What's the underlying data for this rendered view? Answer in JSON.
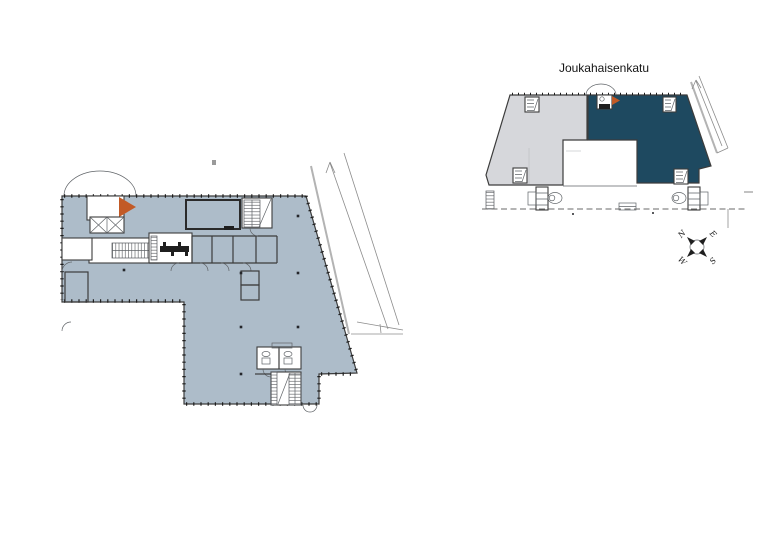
{
  "overview": {
    "street_label": "Joukahaisenkatu"
  },
  "compass": {
    "north": "N",
    "east": "E",
    "south": "S",
    "west": "W"
  },
  "colors": {
    "floor_plan_fill": "#adbcc9",
    "overview_building_fill": "#d6d7db",
    "overview_highlight_fill": "#1e4960",
    "entrance_marker_orange": "#c25a26"
  },
  "icons": {
    "main_entrance_marker": "orange-triangle-right",
    "overview_entrance_marker": "orange-triangle-right",
    "north_arrow": "compass-rose",
    "street_direction": "arrow-up-along-street"
  }
}
